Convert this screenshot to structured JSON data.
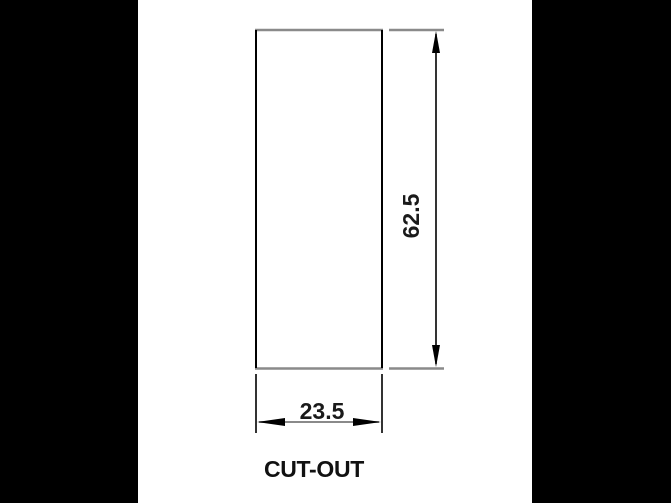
{
  "drawing": {
    "label": "CUT-OUT",
    "height_dimension": "62.5",
    "width_dimension": "23.5"
  },
  "colors": {
    "background": "#000000",
    "panel": "#ffffff",
    "line_dark": "#000000",
    "line_gray": "#8a8a8a",
    "text": "#1a1a1a"
  }
}
